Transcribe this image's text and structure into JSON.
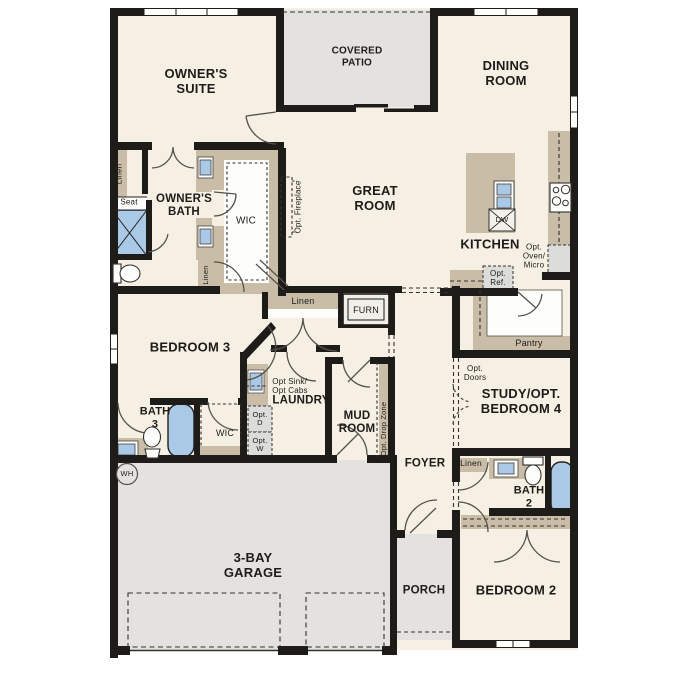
{
  "plan": {
    "labels": {
      "owners_suite": "OWNER'S\nSUITE",
      "covered_patio": "COVERED\nPATIO",
      "dining_room": "DINING\nROOM",
      "great_room": "GREAT\nROOM",
      "owners_bath": "OWNER'S\nBATH",
      "wic_owner": "WIC",
      "linen_owner": "Linen",
      "linen_small": "Linen",
      "seat": "Seat",
      "opt_fireplace": "Opt. Fireplace",
      "kitchen": "KITCHEN",
      "dw": "DW",
      "opt_oven_micro": "Opt.\nOven/\nMicro",
      "opt_ref": "Opt.\nRef.",
      "pantry": "Pantry",
      "linen_hall": "Linen",
      "furn": "FURN",
      "bedroom3": "BEDROOM 3",
      "bath3": "BATH\n3",
      "wic_b3": "WIC",
      "opt_sink_cabs": "Opt Sink/\nOpt Cabs",
      "laundry": "LAUNDRY",
      "opt_d": "Opt.\nD",
      "opt_w": "Opt.\nW",
      "opt_drop_zone": "Opt. Drop Zone",
      "mud_room": "MUD\nROOM",
      "foyer": "FOYER",
      "opt_doors": "Opt.\nDoors",
      "study": "STUDY/OPT.\nBEDROOM 4",
      "linen_b2": "Linen",
      "bath2": "BATH\n2",
      "bedroom2": "BEDROOM 2",
      "porch": "PORCH",
      "garage": "3-BAY\nGARAGE",
      "wh": "WH"
    },
    "colors": {
      "wall": "#1d1c19",
      "floor": "#f6efe3",
      "outdoor": "#e3e2df",
      "cabinetry": "#c9bda7",
      "plumbing_blue": "#a9c9e6",
      "appliance_gray": "#dcdcda"
    }
  }
}
